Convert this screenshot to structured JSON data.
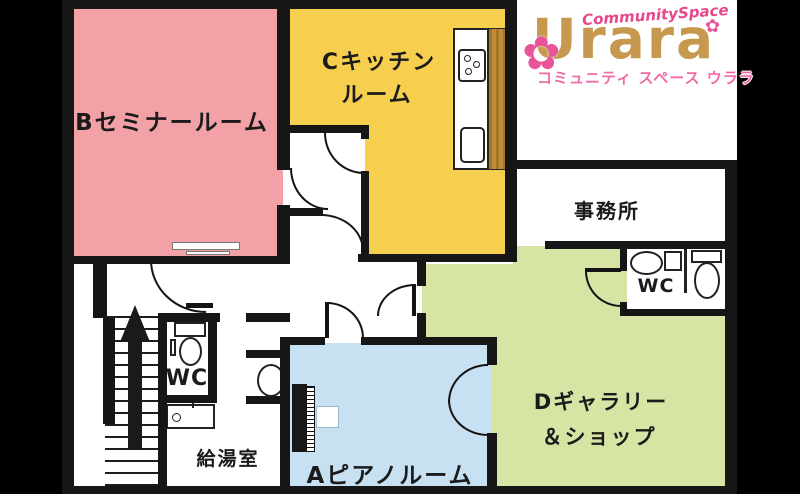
{
  "logo": {
    "script": "CommunitySpace",
    "wordmark": "Urara",
    "subtitle": "コミュニティ スペース ウララ"
  },
  "rooms": {
    "b_seminar": {
      "label": "Bセミナールーム",
      "color": "#F2A2A6"
    },
    "c_kitchen": {
      "line1": "Cキッチン",
      "line2": "ルーム",
      "color": "#F7CF4F"
    },
    "office": {
      "label": "事務所",
      "color": "#FFFFFF"
    },
    "wc_right": {
      "label": "WC"
    },
    "wc_left": {
      "label": "WC"
    },
    "d_gallery": {
      "line1": "Dギャラリー",
      "line2": "＆ショップ",
      "color": "#D6E5A4"
    },
    "a_piano": {
      "label": "Aピアノルーム",
      "color": "#C7E1F2"
    },
    "kitchenette": {
      "label": "給湯室"
    }
  },
  "colors": {
    "background": "#000000",
    "floor": "#FFFFFF",
    "wall": "#161616",
    "logo_tan": "#C6994E",
    "logo_pink": "#F06BA5",
    "wood_counter": "#B5822F"
  }
}
